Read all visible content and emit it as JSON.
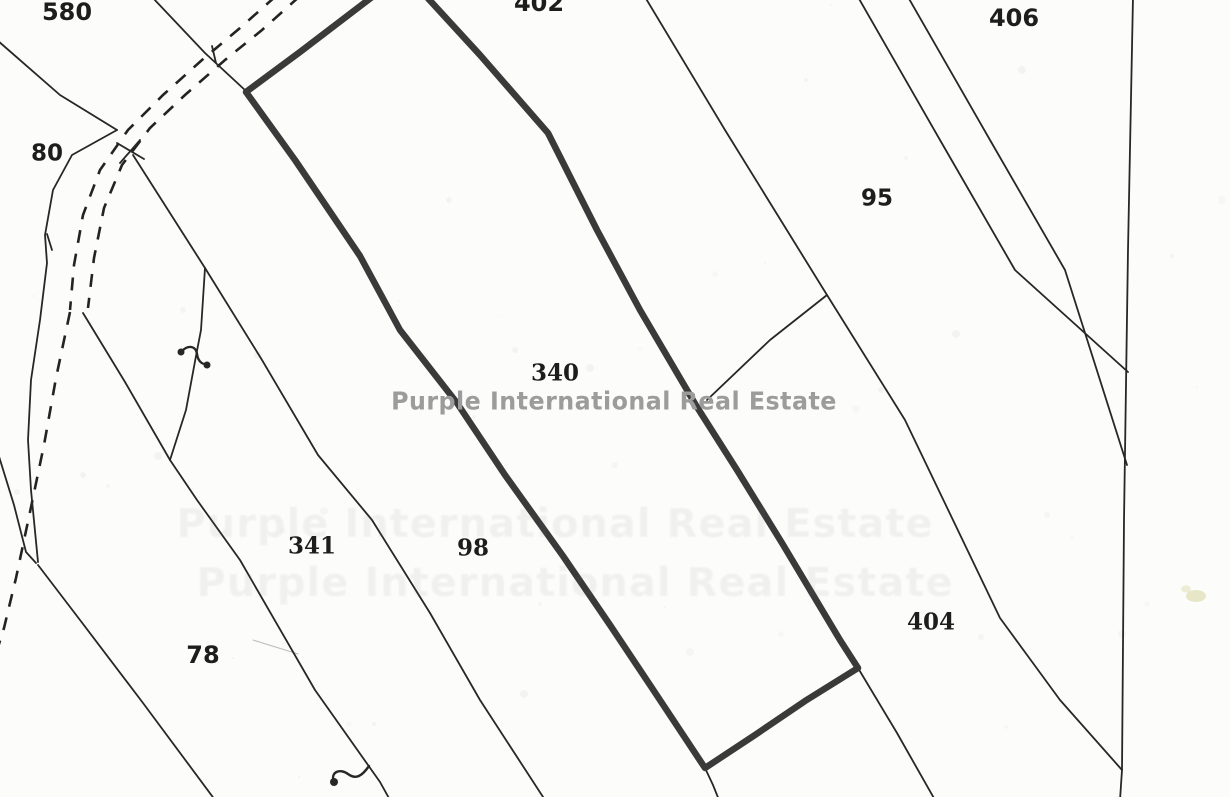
{
  "map": {
    "width": 1230,
    "height": 797,
    "paper_color": "#fcfcfa",
    "thin_line_color": "#272727",
    "bold_line_color": "#3a3a3a",
    "dash_line_color": "#232323",
    "watermark": {
      "text": "Purple International Real Estate",
      "color": "#9c9c9c",
      "x": 614,
      "y": 401,
      "font_size": 25
    },
    "ghost_watermark": {
      "text": "Purple International Real Estate",
      "opacity": 0.075,
      "font_size": 40,
      "rows": [
        {
          "x": 555,
          "y": 524
        },
        {
          "x": 575,
          "y": 583
        }
      ]
    },
    "parcel_labels": [
      {
        "text": "580",
        "x": 67,
        "y": 12,
        "size": 24,
        "font": "sans"
      },
      {
        "text": "80",
        "x": 47,
        "y": 154,
        "size": 23,
        "font": "sans"
      },
      {
        "text": "402",
        "x": 539,
        "y": 3,
        "size": 24,
        "font": "sans"
      },
      {
        "text": "406",
        "x": 1014,
        "y": 18,
        "size": 24,
        "font": "sans"
      },
      {
        "text": "95",
        "x": 877,
        "y": 199,
        "size": 23,
        "font": "sans"
      },
      {
        "text": "340",
        "x": 555,
        "y": 373,
        "size": 23,
        "font": "serif"
      },
      {
        "text": "341",
        "x": 312,
        "y": 546,
        "size": 23,
        "font": "serif"
      },
      {
        "text": "98",
        "x": 473,
        "y": 548,
        "size": 23,
        "font": "serif"
      },
      {
        "text": "404",
        "x": 931,
        "y": 622,
        "size": 23,
        "font": "serif"
      },
      {
        "text": "78",
        "x": 203,
        "y": 655,
        "size": 24,
        "font": "sans"
      }
    ],
    "highlighted_parcel": {
      "label": "340",
      "outline_points": "376,-6 300,52 246,92 295,160 360,256 400,330 457,403 505,475 563,556 610,625 652,688 705,768 755,735 805,701 858,668 840,640 782,543 737,470 697,407 640,310 597,230 548,133 480,55 424,-6",
      "stroke_width": 6.5
    },
    "thin_lines": [
      {
        "name": "boundary-580-402",
        "points": "152,-3 205,53 246,91"
      },
      {
        "name": "boundary-80-upper",
        "points": "-3,40 60,95 117,130"
      },
      {
        "name": "x-mark-stroke-1",
        "points": "117,143 144,159"
      },
      {
        "name": "x-mark-stroke-2",
        "points": "140,140 120,163"
      },
      {
        "name": "boundary-80-left-curve",
        "points": "117,130 72,155 53,190 45,235 47,263 40,320 31,380 28,440 31,490 38,562"
      },
      {
        "name": "boundary-left-lower",
        "points": "-3,450 14,505 26,552 36,563"
      },
      {
        "name": "boundary-78-left",
        "points": "38,565 80,620 143,703 215,800"
      },
      {
        "name": "boundary-road-spur",
        "points": "83,313 125,382 170,460"
      },
      {
        "name": "boundary-x-to-junction",
        "points": "133,155 205,268"
      },
      {
        "name": "boundary-vertical-squiggle",
        "points": "205,268 201,330 196,356 186,410 170,460"
      },
      {
        "name": "boundary-78-341",
        "points": "170,460 197,500 240,560 315,690 368,765 380,782 390,800"
      },
      {
        "name": "boundary-341-98",
        "points": "205,268 262,360 318,455 372,520 430,613 480,700 545,800"
      },
      {
        "name": "boundary-95-404-long",
        "points": "645,-3 725,130 827,295 905,420 1000,618 1060,700 1122,770"
      },
      {
        "name": "boundary-95-404-spur",
        "points": "827,295 770,340 707,400"
      },
      {
        "name": "boundary-340-bottom-right-ext",
        "points": "858,668 897,733 935,800"
      },
      {
        "name": "boundary-340-bottom-left-ext",
        "points": "705,768 713,785 719,800"
      },
      {
        "name": "boundary-right-vertical",
        "points": "1133,-3 1128,250 1124,520 1122,770 1120,800"
      },
      {
        "name": "boundary-406-upper",
        "points": "858,-3 940,140 1015,270 1128,372"
      },
      {
        "name": "boundary-406-lower",
        "points": "908,-3 990,140 1065,270 1127,465"
      },
      {
        "name": "survey-tick-1",
        "points": "212,46 216,63"
      },
      {
        "name": "survey-tick-2",
        "points": "47,234 52,250"
      },
      {
        "name": "faint-scratch-78",
        "points": "253,640 298,654",
        "w": 1,
        "o": 0.3
      }
    ],
    "dashed_lines": [
      {
        "name": "road-dashed-right",
        "points": "300,-4 262,30 225,60 185,95 150,128 122,165 104,208 94,258 88,308"
      },
      {
        "name": "road-dashed-left",
        "points": "276,-4 240,28 202,60 163,95 128,130 100,170 83,215 74,265 70,310"
      },
      {
        "name": "road-dashed-lower",
        "points": "70,312 56,378 44,445 30,512 16,578 4,628 -6,660"
      }
    ],
    "symbols": {
      "dots": [
        {
          "name": "hook-dot",
          "x": 334,
          "y": 782,
          "r": 4
        },
        {
          "name": "squiggle-dot-left",
          "x": 181,
          "y": 352,
          "r": 3.5
        },
        {
          "name": "squiggle-dot-right",
          "x": 207,
          "y": 365,
          "r": 3.5
        }
      ],
      "paths": [
        {
          "name": "hook-curl",
          "d": "M 334,782 C 330,772 340,768 348,774 C 356,780 362,776 369,766"
        },
        {
          "name": "squiggle-curl",
          "d": "M 181,352 C 188,344 196,346 197,354 C 198,362 204,366 207,363"
        }
      ]
    },
    "smudges": [
      {
        "name": "yellow-smudge",
        "x": 1196,
        "y": 596,
        "rx": 10,
        "ry": 6,
        "color": "#d6d69f",
        "opacity": 0.55
      },
      {
        "name": "yellow-smudge-small",
        "x": 1186,
        "y": 589,
        "rx": 5,
        "ry": 3.5,
        "color": "#dedeb0",
        "opacity": 0.5
      }
    ]
  }
}
